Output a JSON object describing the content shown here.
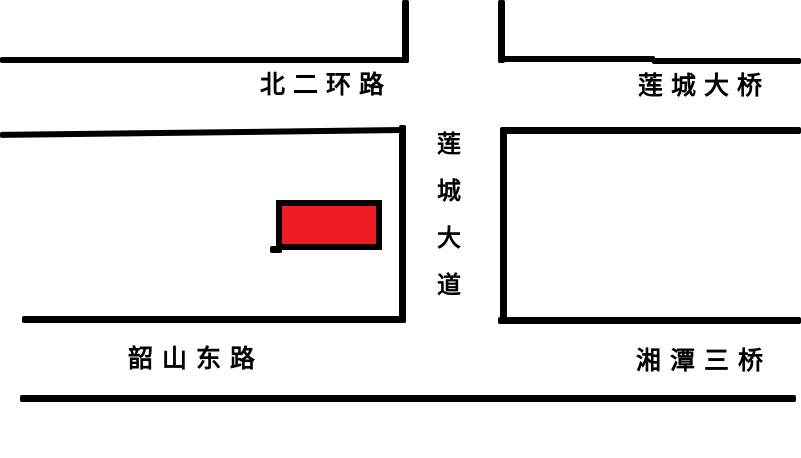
{
  "colors": {
    "background": "#FFFFFF",
    "road_line": "#000000",
    "marker_fill": "#ED1C24",
    "marker_border": "#000000"
  },
  "labels": {
    "north_second_ring_road": "北二环路",
    "liancheng_bridge": "莲城大桥",
    "shaoshan_east_road": "韶山东路",
    "xiangtan_third_bridge": "湘潭三桥",
    "liancheng_avenue_chars": [
      "莲",
      "城",
      "大",
      "道"
    ]
  }
}
